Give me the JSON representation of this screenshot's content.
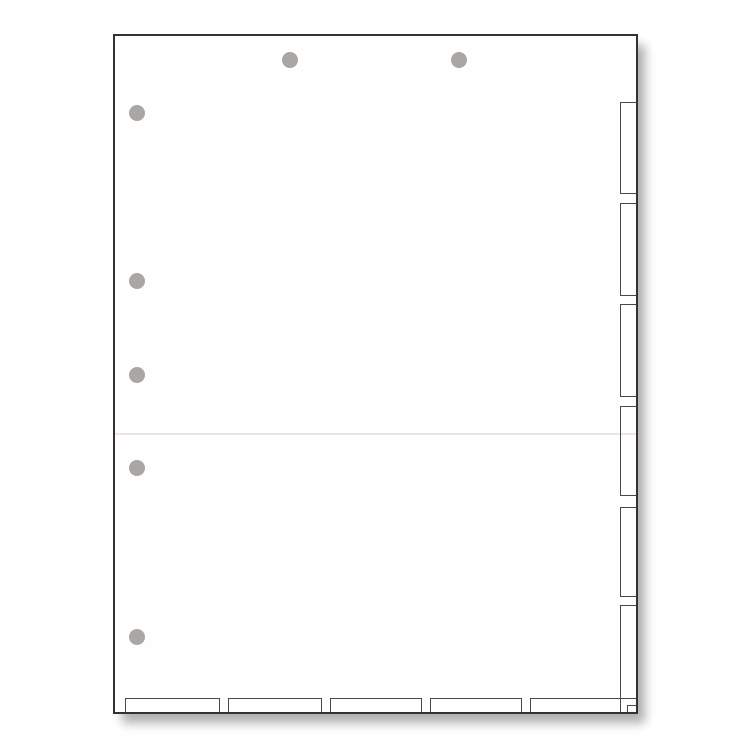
{
  "meta": {
    "description": "Product photograph of a blank white chart divider sheet with die-cut index tabs along the right and bottom edges, two punched holes at the top, five punched holes along the left edge, and a faint horizontal fold line across the middle. The sheet rests on a plain white background and casts a soft drop shadow toward the lower right.",
    "background_color": "#ffffff"
  },
  "colors": {
    "sheet_fill": "#fefefe",
    "sheet_border": "#36312c",
    "tab_outline": "#4c4742",
    "fold_line": "#ece5e2",
    "hole_fill": "#a9a6a3",
    "shadow": "rgba(0,0,0,0.32)"
  },
  "sheet": {
    "x": 113,
    "y": 34,
    "width": 525,
    "height": 680,
    "border_width": 2
  },
  "fold_line": {
    "top": 397
  },
  "right_tabs": [
    {
      "top": 66,
      "height": 92
    },
    {
      "top": 167,
      "height": 93
    },
    {
      "top": 268,
      "height": 93
    },
    {
      "top": 370,
      "height": 90
    },
    {
      "top": 471,
      "height": 90
    },
    {
      "top": 569,
      "height": 94
    }
  ],
  "bottom_tabs": [
    {
      "left": 10,
      "width": 95
    },
    {
      "left": 113,
      "width": 94
    },
    {
      "left": 215,
      "width": 92
    },
    {
      "left": 315,
      "width": 92
    },
    {
      "left": 415,
      "width": 91
    }
  ],
  "corner_notch": {
    "width": 9,
    "height": 7
  },
  "holes": {
    "diameter": 16,
    "top_row": [
      {
        "cx": 175,
        "cy": 24
      },
      {
        "cx": 344,
        "cy": 24
      }
    ],
    "left_column": [
      {
        "cx": 22,
        "cy": 77
      },
      {
        "cx": 22,
        "cy": 245
      },
      {
        "cx": 22,
        "cy": 339
      },
      {
        "cx": 22,
        "cy": 432
      },
      {
        "cx": 22,
        "cy": 601
      }
    ]
  }
}
